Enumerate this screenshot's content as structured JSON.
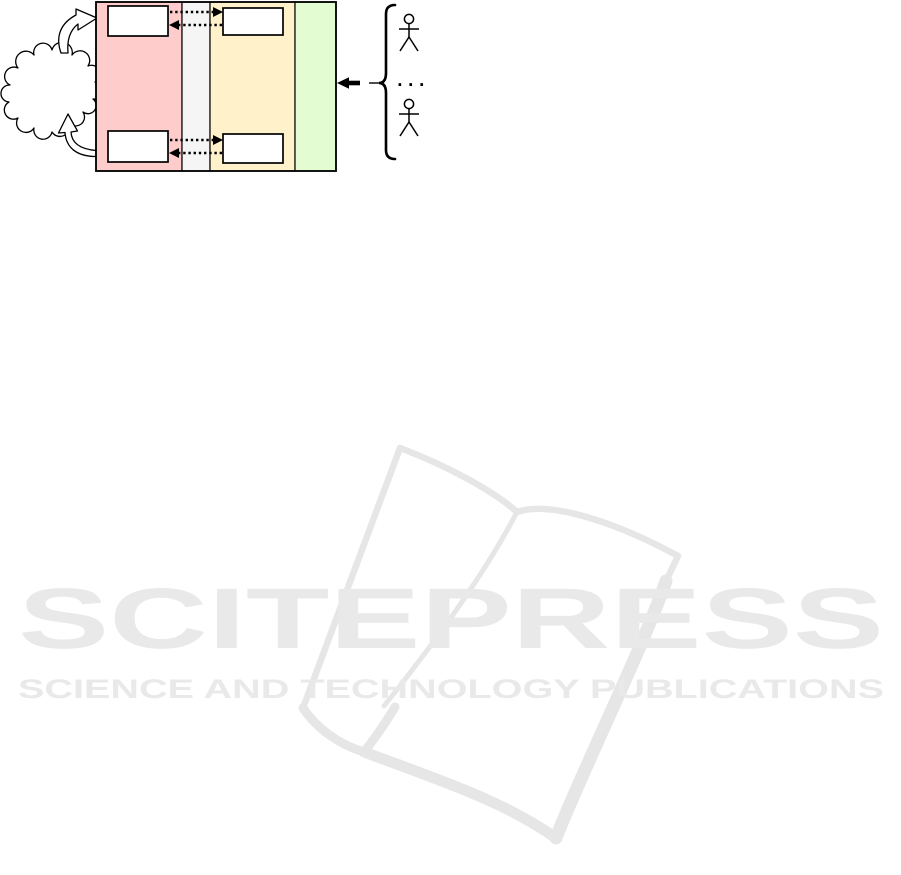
{
  "watermark": {
    "brand": "SCITEPRESS",
    "tagline": "SCIENCE AND TECHNOLOGY PUBLICATIONS",
    "text_color": "#e9e9e9",
    "book_color": "#e6e6e6"
  },
  "figure": {
    "cloud": {
      "fill": "#ffffff",
      "stroke": "#000000"
    },
    "regions": [
      {
        "name": "left-red-band",
        "color": "#ffcccc"
      },
      {
        "name": "gray-gap-band",
        "color": "#f5f5f5"
      },
      {
        "name": "middle-yellow-band",
        "color": "#fff2cb"
      },
      {
        "name": "right-green-band",
        "color": "#e3fcd1"
      }
    ],
    "modules": [
      {
        "name": "red-top-box",
        "fill": "#ffffff"
      },
      {
        "name": "yellow-top-box",
        "fill": "#ffffff"
      },
      {
        "name": "red-bottom-box",
        "fill": "#ffffff"
      },
      {
        "name": "yellow-bottom-box",
        "fill": "#ffffff"
      }
    ],
    "users_group": {
      "ellipsis": ". . ."
    }
  }
}
